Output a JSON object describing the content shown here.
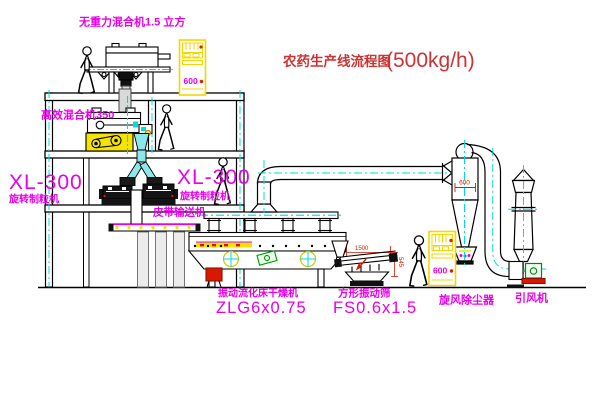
{
  "title": {
    "text": "农药生产线流程图",
    "capacity": "(500kg/h)"
  },
  "labels": {
    "zero_gravity_mixer": "无重力混合机1.5 立方",
    "high_efficiency_mixer": "高效混合机350",
    "granulator_left_model": "XL-300",
    "granulator_left_name": "旋转制粒机",
    "granulator_right_model": "XL-300",
    "granulator_right_name": "旋转制粒机",
    "belt_conveyor": "皮带输送机",
    "dryer_name": "振动流化床干燥机",
    "dryer_model": "ZLG6x0.75",
    "screen_name": "方形振动筛",
    "screen_model": "FS0.6x1.5",
    "cyclone": "旋风除尘器",
    "fan": "引风机"
  },
  "dimensions": {
    "screen_length": "1500",
    "screen_height": "545",
    "cyclone_width": "600",
    "cabinet_top": "600",
    "cabinet_bottom": "600"
  },
  "colors": {
    "label_magenta": "#e800e8",
    "title_red": "#cc3333",
    "centerline_cyan": "#00dcdc",
    "highlight_yellow": "#f5e400",
    "line_black": "#000000"
  }
}
